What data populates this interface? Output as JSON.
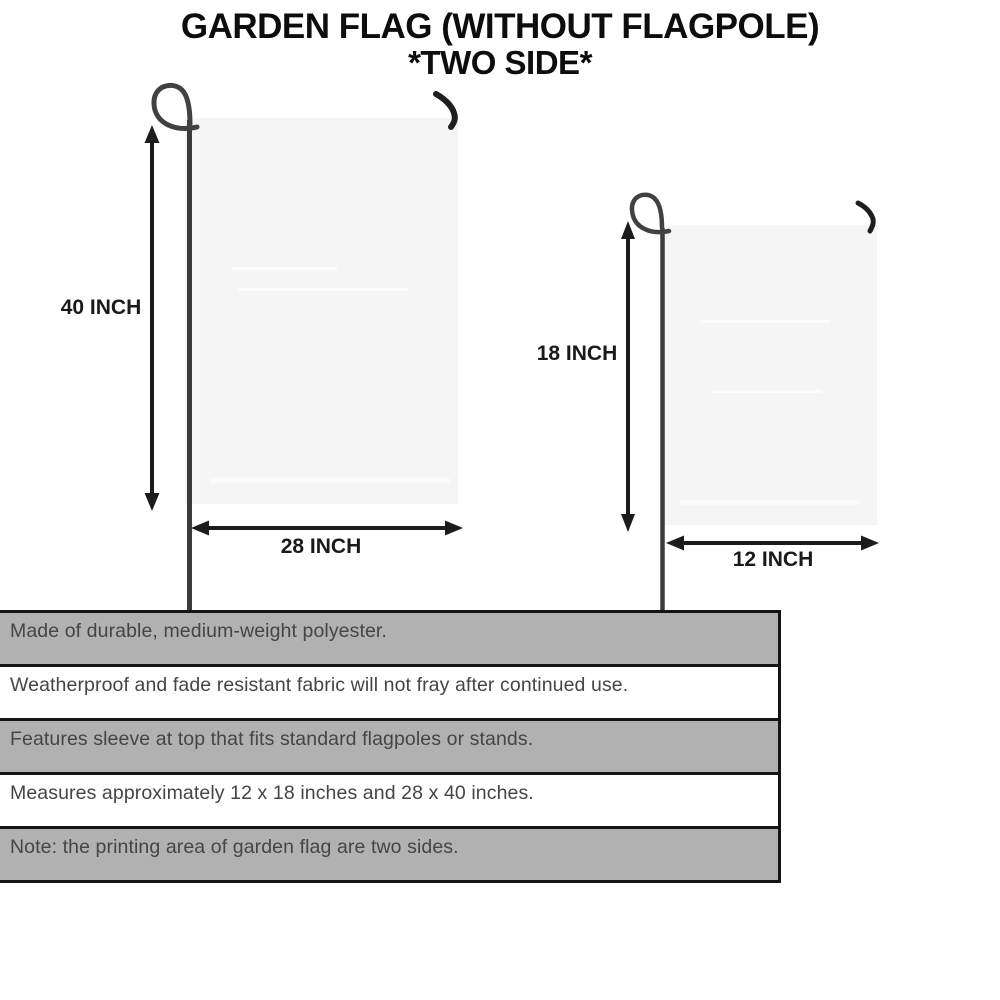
{
  "title": {
    "line1": "GARDEN FLAG (WITHOUT FLAGPOLE)",
    "line2": "*TWO SIDE*"
  },
  "diagram": {
    "large_flag": {
      "name": "large garden flag",
      "height_label": "40 INCH",
      "width_label": "28 INCH"
    },
    "small_flag": {
      "name": "small garden flag",
      "height_label": "18 INCH",
      "width_label": "12 INCH"
    }
  },
  "features": [
    {
      "text": "Made of durable, medium-weight polyester.",
      "shaded": true
    },
    {
      "text": "Weatherproof and fade resistant fabric will not fray after continued use.",
      "shaded": false
    },
    {
      "text": "Features sleeve at top that fits standard flagpoles or stands.",
      "shaded": true
    },
    {
      "text": "Measures approximately 12 x 18 inches and 28 x 40 inches.",
      "shaded": false
    },
    {
      "text": "Note: the printing area of garden flag are two sides.",
      "shaded": true
    }
  ],
  "colors": {
    "background": "#ffffff",
    "flag_fill": "#f5f5f6",
    "pole": "#3b3b3b",
    "hook": "#1e1e1e",
    "arrow": "#1c1c1c",
    "row_shaded": "#b1b1b1",
    "row_plain": "#ffffff",
    "table_border": "#141414",
    "feature_text": "#454545",
    "title_text": "#0d0d0d"
  }
}
